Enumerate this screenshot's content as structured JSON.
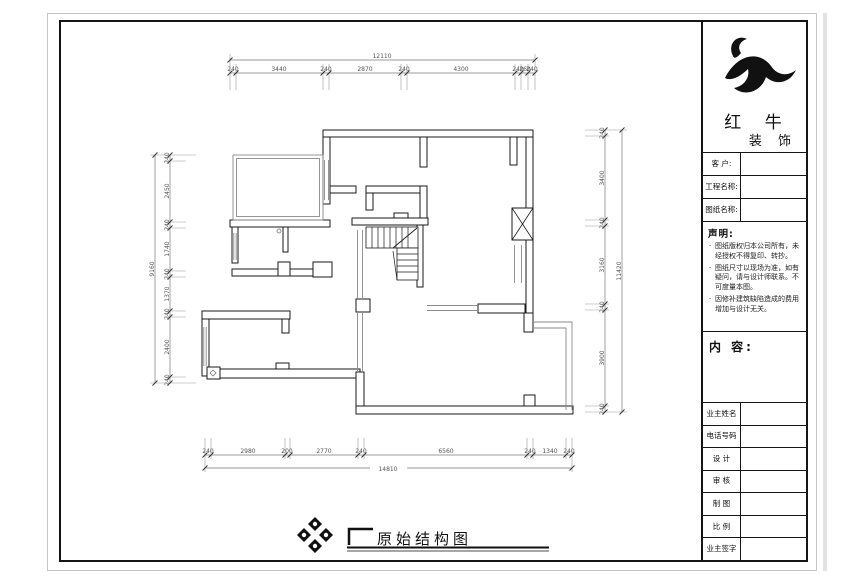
{
  "drawing": {
    "title": "原始结构图",
    "dims_top": {
      "overall": "12110",
      "segments": [
        "240",
        "3440",
        "240",
        "2870",
        "240",
        "4300",
        "240",
        "260",
        "240"
      ]
    },
    "dims_bottom": {
      "overall": "14810",
      "segments": [
        "240",
        "2980",
        "200",
        "2770",
        "240",
        "6560",
        "240",
        "1340",
        "240"
      ]
    },
    "dims_left": {
      "overall": "9160",
      "segments": [
        "240",
        "2450",
        "240",
        "1740",
        "240",
        "1370",
        "240",
        "2400",
        "240"
      ]
    },
    "dims_right": {
      "overall": "11420",
      "segments": [
        "240",
        "3400",
        "240",
        "3160",
        "240",
        "3900",
        "240"
      ]
    }
  },
  "title_block": {
    "brand": {
      "line1": "红 牛",
      "line2": "装 饰"
    },
    "fields": [
      {
        "label": "客 户:",
        "value": ""
      },
      {
        "label": "工程名称:",
        "value": ""
      },
      {
        "label": "图纸名称:",
        "value": ""
      }
    ],
    "statement": {
      "heading": "声明:",
      "items": [
        "图纸版权归本公司所有，未经授权不得复印、转抄。",
        "图纸尺寸以现场为准，如有疑问，请与设计师联系。不可度量本图。",
        "因修补建筑缺陷造成的费用增加与设计无关。"
      ]
    },
    "content_label": "内 容:",
    "info_rows": [
      {
        "label": "业主姓名",
        "value": ""
      },
      {
        "label": "电话号码",
        "value": ""
      },
      {
        "label": "设 计",
        "value": ""
      },
      {
        "label": "审 核",
        "value": ""
      },
      {
        "label": "制 图",
        "value": ""
      },
      {
        "label": "比 例",
        "value": ""
      },
      {
        "label": "业主签字",
        "value": ""
      }
    ]
  },
  "icons": {
    "logo": "bull-logo",
    "ornament": "diamond-compass-ornament"
  },
  "colors": {
    "wall_line": "#1a1a1a",
    "thin_line": "#8a8a8a",
    "dim_text": "#555555"
  }
}
